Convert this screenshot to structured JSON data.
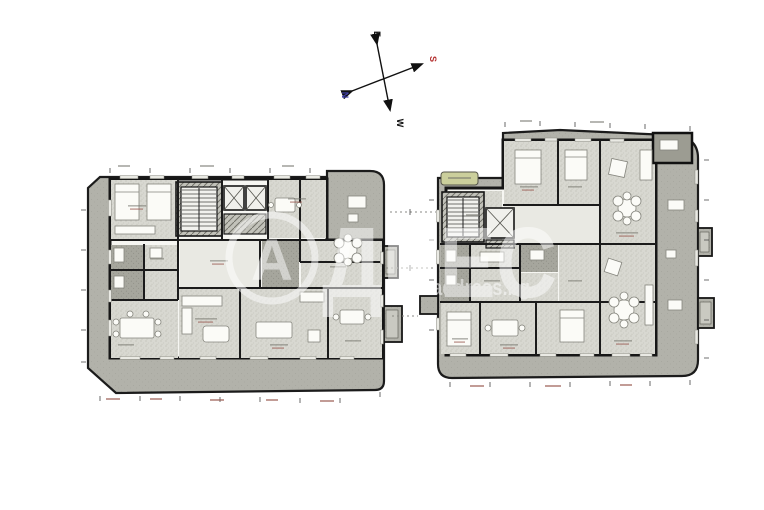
{
  "compass": {
    "north": "N",
    "south": "S",
    "east": "E",
    "west": "W"
  },
  "watermark": {
    "logo_letter": "А",
    "brand_letters": "ДРЕС",
    "website": "address.bg"
  },
  "colors": {
    "paper": "#ffffff",
    "terrace": "#b2b2aa",
    "floor_light": "#d8d8d1",
    "floor_dark": "#9c9c92",
    "wall": "#1b1b1b",
    "highlight_green": "#cbcf9c",
    "compass_axis": "#111111",
    "compass_north": "#4343ad",
    "compass_south": "#b43030",
    "watermark_white": "#ffffff",
    "dimension_text": "#9a5a50"
  }
}
